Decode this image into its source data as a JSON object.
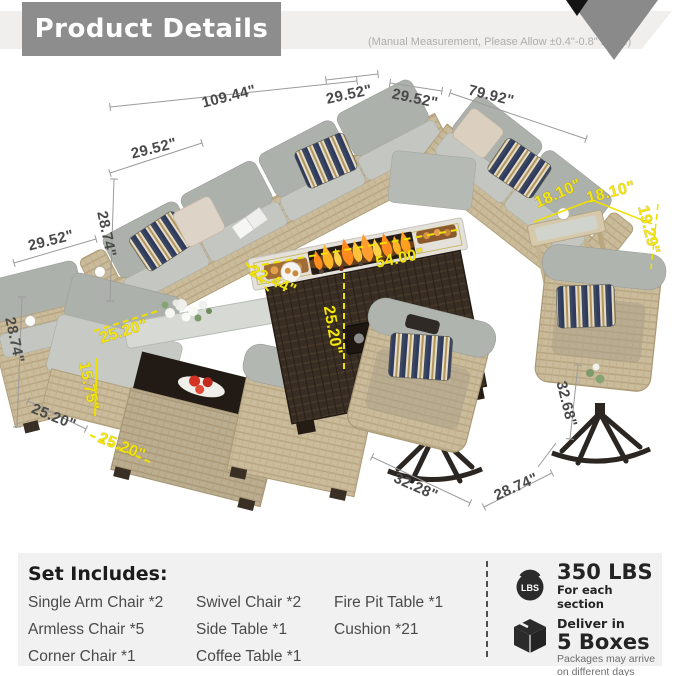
{
  "header": {
    "title": "Product Details",
    "note": "(Manual Measurement, Please Allow ±0.4\"-0.8\" Error.)"
  },
  "dims": {
    "main_back": "109.44\"",
    "corner_left": "29.52\"",
    "corner_right": "29.52\"",
    "right_back": "79.92\"",
    "left_arm": "29.52\"",
    "left_side": "29.52\"",
    "sofa_height": "28.74\"",
    "armchair_height": "28.74\"",
    "armchair_width": "25.20\"",
    "armless_seat_width": "25.20\"",
    "coffee_table_height": "15.75\"",
    "coffee_table_width": "25.20\"",
    "firepit_length": "54.00\"",
    "firepit_width": "22.44\"",
    "firepit_height": "25.20\"",
    "side_table_width": "18.10\"",
    "side_table_depth": "18.10\"",
    "side_table_height": "19.29\"",
    "swivel_width": "32.28\"",
    "swivel_depth": "28.74\"",
    "swivel_height": "32.68\""
  },
  "set_includes": {
    "heading": "Set Includes:",
    "col1": [
      "Single Arm Chair *2",
      "Armless Chair  *5",
      "Corner Chair *1"
    ],
    "col2": [
      "Swivel Chair *2",
      "Side Table *1",
      "Coffee Table *1"
    ],
    "col3": [
      "Fire Pit Table *1",
      "Cushion *21"
    ]
  },
  "shipping": {
    "lbs_label": "LBS",
    "weight": "350 LBS",
    "weight_note": "For each section",
    "deliver_prefix": "Deliver in",
    "boxes": "5 Boxes",
    "boxes_note_line1": "Packages may arrive",
    "boxes_note_line2": "on different days"
  },
  "colors": {
    "dimension_yellow": "#f4e60b",
    "dimension_gray": "#4a4a4a",
    "title_bg": "#8d8d8d",
    "panel_bg": "#f1f1f1"
  }
}
